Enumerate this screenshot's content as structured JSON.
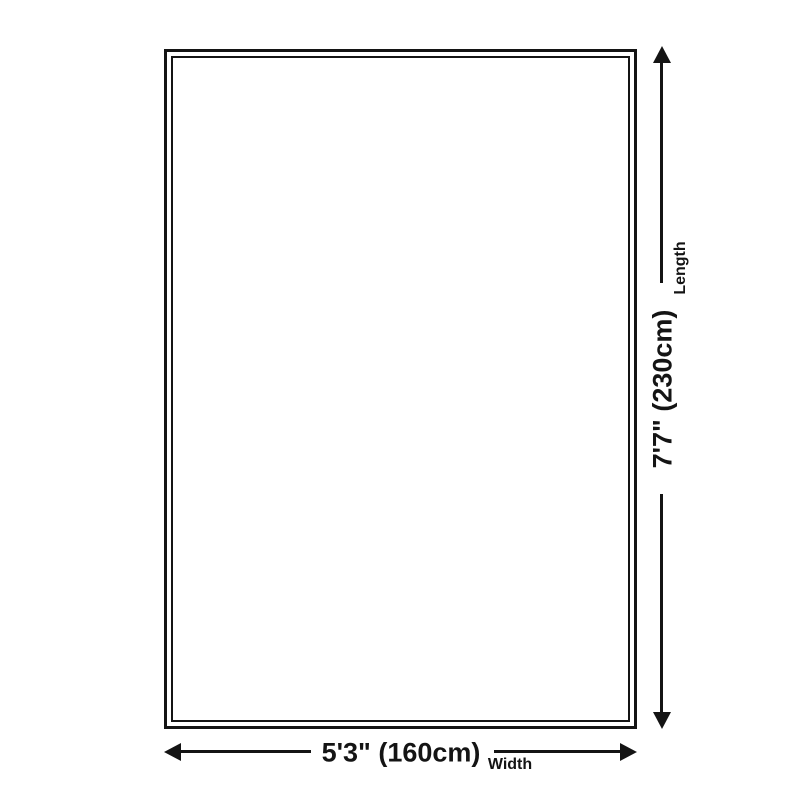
{
  "diagram": {
    "type": "product-dimension-diagram",
    "background_color": "#ffffff",
    "line_color": "#141414",
    "rug": {
      "border_style": "double"
    },
    "length": {
      "value": "7'7\" (230cm)",
      "label": "Length"
    },
    "width": {
      "value": "5'3\" (160cm)",
      "label": "Width"
    }
  }
}
